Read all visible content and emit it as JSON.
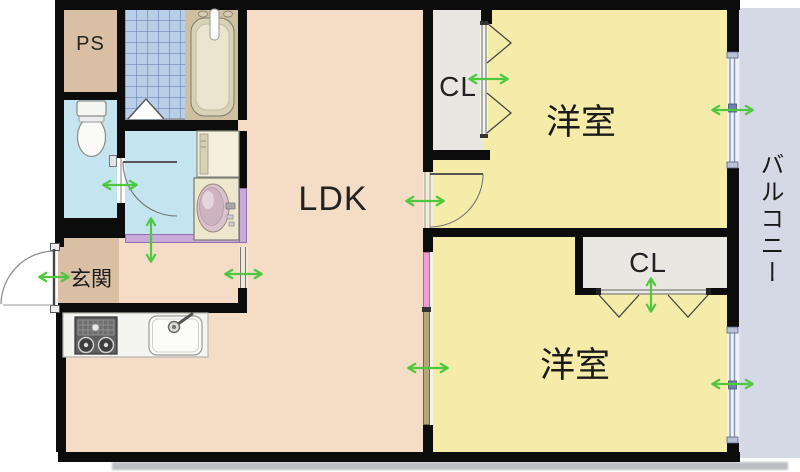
{
  "rooms": {
    "ps": {
      "label": "PS"
    },
    "ldk": {
      "label": "LDK"
    },
    "genkan": {
      "label": "玄関"
    },
    "closet_top": {
      "label": "CL"
    },
    "closet_bottom": {
      "label": "CL"
    },
    "bedroom_top": {
      "label": "洋室"
    },
    "bedroom_bottom": {
      "label": "洋室"
    },
    "balcony": {
      "label": "バルコニー"
    }
  },
  "fixtures": [
    "bathtub",
    "shower-mixer",
    "washing-machine",
    "vanity-basin",
    "toilet",
    "gas-stove",
    "kitchen-sink",
    "tiled-bathroom-floor"
  ],
  "colors": {
    "wall": "#0c0c0c",
    "ldk_floor": "#f4dcc6",
    "bedroom_floor": "#f5ecaa",
    "closet_floor": "#e9e7e1",
    "entry_floor": "#d9c0a4",
    "washroom_floor": "#c4e4f0",
    "toilet_floor": "#c4e4f0",
    "bath_tile": "#b9cfe8",
    "balcony_floor": "#d4d9e5",
    "tub_surround": "#cdbfa0",
    "sliding_door_pink": "#ec9ed8",
    "sliding_door_tan": "#b2a87c",
    "lavender_wall": "#c9aad9",
    "arrow_green": "#4fc83f",
    "window_frame": "#8794b8"
  }
}
